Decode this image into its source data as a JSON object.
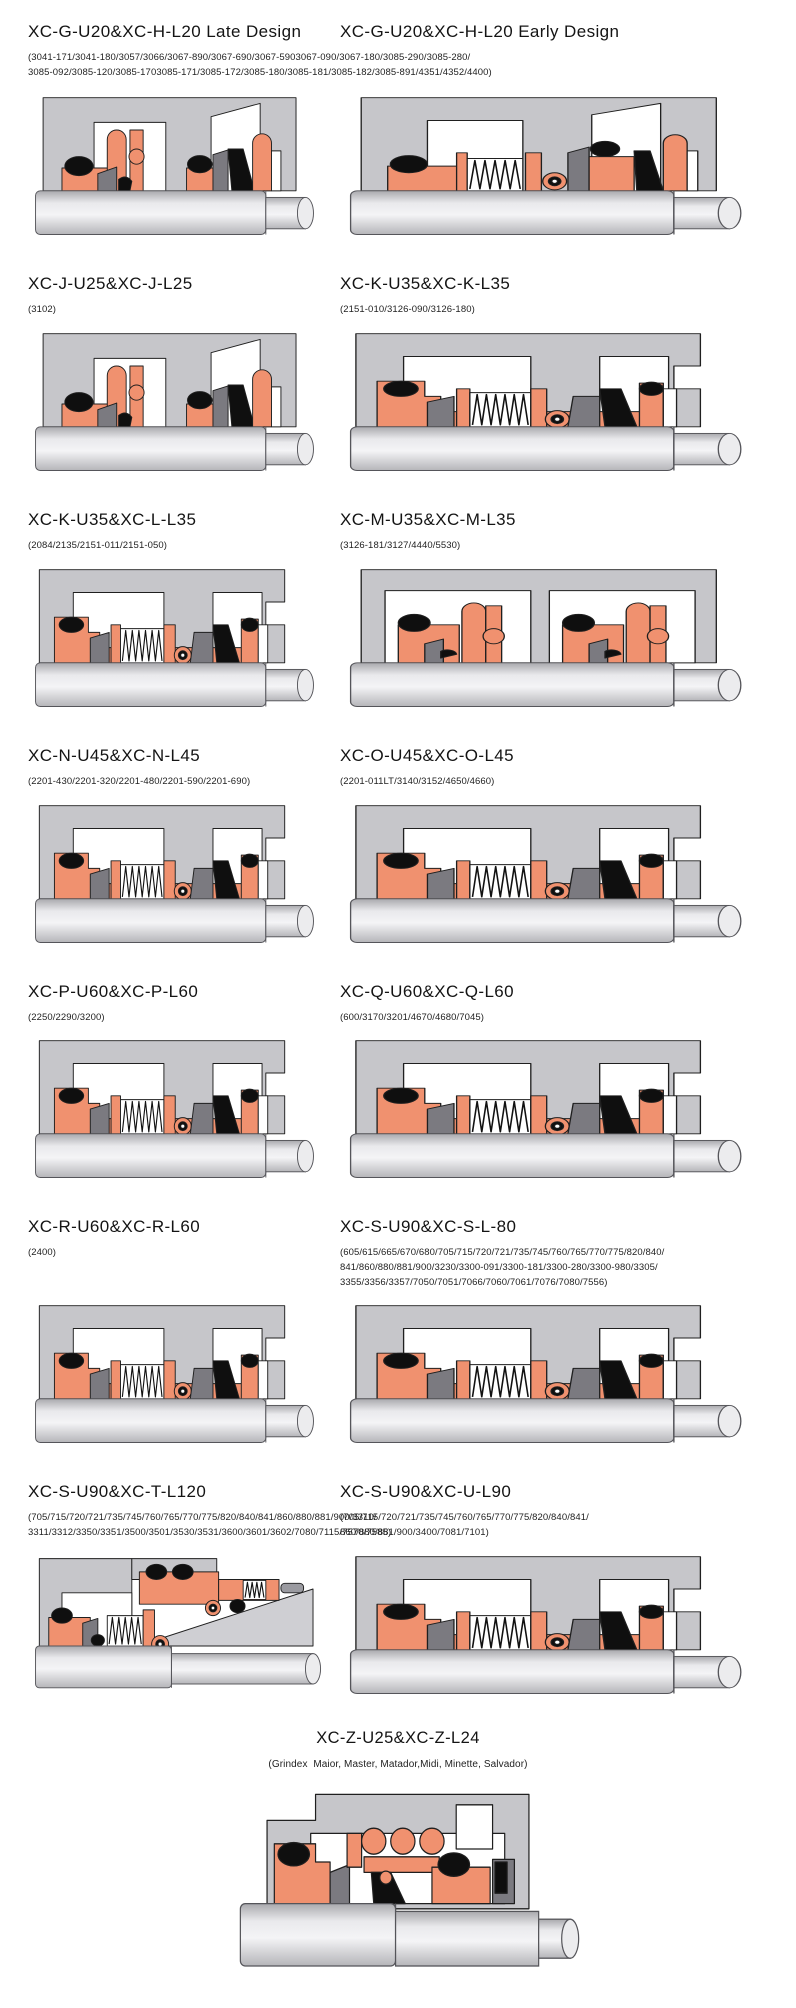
{
  "colors": {
    "seal_salmon": "#f0916f",
    "housing_gray": "#c6c6ca",
    "wedge_gray": "#cfcfd3",
    "component_gray": "#7b7a80",
    "elastomer_black": "#0f0f0f",
    "pin_gray": "#9a9aa0",
    "outline": "#1f1f1f",
    "background": "#ffffff",
    "text": "#1a1a1a"
  },
  "rows": [
    {
      "shared_subtitle": "(3041-171/3041-180/3057/3066/3067-890/3067-690/3067-5903067-090/3067-180/3085-290/3085-280/\n3085-092/3085-120/3085-1703085-171/3085-172/3085-180/3085-181/3085-182/3085-891/4351/4352/4400)",
      "cells": [
        {
          "title": "XC-G-U20&XC-H-L20 Late Design",
          "diagram": "compact-dual-seal"
        },
        {
          "title": "XC-G-U20&XC-H-L20 Early Design",
          "diagram": "compact-dual-seal-spring"
        }
      ]
    },
    {
      "cells": [
        {
          "title": "XC-J-U25&XC-J-L25",
          "subtitle": "(3102)",
          "diagram": "compact-dual-seal"
        },
        {
          "title": "XC-K-U35&XC-K-L35",
          "subtitle": "(2151-010/3126-090/3126-180)",
          "diagram": "single-spring-seal"
        }
      ]
    },
    {
      "cells": [
        {
          "title": "XC-K-U35&XC-L-L35",
          "subtitle": "(2084/2135/2151-011/2151-050)",
          "diagram": "single-spring-seal"
        },
        {
          "title": "XC-M-U35&XC-M-L35",
          "subtitle": "(3126-181/3127/4440/5530)",
          "diagram": "twin-seal"
        }
      ]
    },
    {
      "cells": [
        {
          "title": "XC-N-U45&XC-N-L45",
          "subtitle": "(2201-430/2201-320/2201-480/2201-590/2201-690)",
          "diagram": "single-spring-seal"
        },
        {
          "title": "XC-O-U45&XC-O-L45",
          "subtitle": "(2201-011LT/3140/3152/4650/4660)",
          "diagram": "single-spring-seal"
        }
      ]
    },
    {
      "cells": [
        {
          "title": "XC-P-U60&XC-P-L60",
          "subtitle": "(2250/2290/3200)",
          "diagram": "single-spring-seal"
        },
        {
          "title": "XC-Q-U60&XC-Q-L60",
          "subtitle": "(600/3170/3201/4670/4680/7045)",
          "diagram": "single-spring-seal"
        }
      ]
    },
    {
      "cells": [
        {
          "title": "XC-R-U60&XC-R-L60",
          "subtitle": "(2400)",
          "diagram": "single-spring-seal"
        },
        {
          "title": "XC-S-U90&XC-S-L-80",
          "subtitle": "(605/615/665/670/680/705/715/720/721/735/745/760/765/770/775/820/840/\n841/860/880/881/900/3230/3300-091/3300-181/3300-280/3300-980/3305/\n3355/3356/3357/7050/7051/7066/7060/7061/7076/7080/7556)",
          "diagram": "single-spring-seal"
        }
      ]
    },
    {
      "cells": [
        {
          "title": "XC-S-U90&XC-T-L120",
          "subtitle": "(705/715/720/721/735/745/760/765/770/775/820/840/841/860/880/881/900/3310/\n3311/3312/3350/3351/3500/3501/3530/3531/3600/3601/3602/7080/7115/7570/7585)",
          "diagram": "stepped-wedge-seal"
        },
        {
          "title": "XC-S-U90&XC-U-L90",
          "subtitle": "(705/715/720/721/735/745/760/765/770/775/820/840/841/\n860/880/881/900/3400/7081/7101)",
          "diagram": "single-spring-seal"
        }
      ]
    },
    {
      "centered": true,
      "cells": [
        {
          "title": "XC-Z-U25&XC-Z-L24",
          "subtitle": "(Grindex  Maior, Master, Matador,Midi, Minette, Salvador)",
          "diagram": "ball-spring-seal"
        }
      ]
    }
  ]
}
